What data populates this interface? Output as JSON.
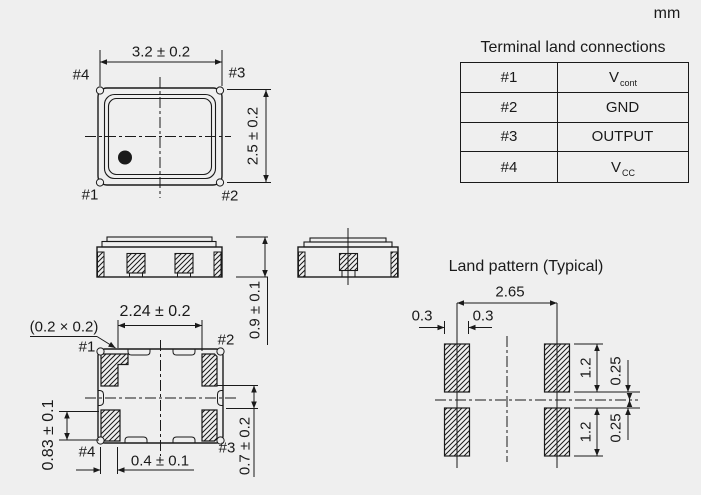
{
  "unit": "mm",
  "colors": {
    "background": "#efefef",
    "line": "#1a1a1a"
  },
  "terminal_table": {
    "title": "Terminal land connections",
    "rows": [
      {
        "terminal": "#1",
        "connection": "V",
        "connection_sub": "cont"
      },
      {
        "terminal": "#2",
        "connection": "GND",
        "connection_sub": ""
      },
      {
        "terminal": "#3",
        "connection": "OUTPUT",
        "connection_sub": ""
      },
      {
        "terminal": "#4",
        "connection": "V",
        "connection_sub": "CC"
      }
    ]
  },
  "top_view": {
    "width_dim": "3.2 ± 0.2",
    "height_dim": "2.5 ± 0.2",
    "labels": {
      "top_left": "#4",
      "top_right": "#3",
      "bottom_left": "#1",
      "bottom_right": "#2"
    }
  },
  "side_views": {
    "height_dim": "0.9 ± 0.1"
  },
  "bottom_view": {
    "index_cut_note": "(0.2 × 0.2)",
    "terminal_span_dim": "2.24 ± 0.2",
    "terminal_height_dim": "0.83 ± 0.1",
    "terminal_width_dim": "0.4 ± 0.1",
    "terminal_gap_dim": "0.7 ± 0.2",
    "labels": {
      "top_left": "#1",
      "top_right": "#2",
      "bottom_left": "#4",
      "bottom_right": "#3"
    }
  },
  "land_pattern": {
    "title": "Land pattern (Typical)",
    "pitch_dim": "2.65",
    "pad_half_width_left": "0.3",
    "pad_half_width_right": "0.3",
    "pad_height_top": "1.2",
    "pad_height_bottom": "1.2",
    "center_gap_top": "0.25",
    "center_gap_bottom": "0.25"
  }
}
